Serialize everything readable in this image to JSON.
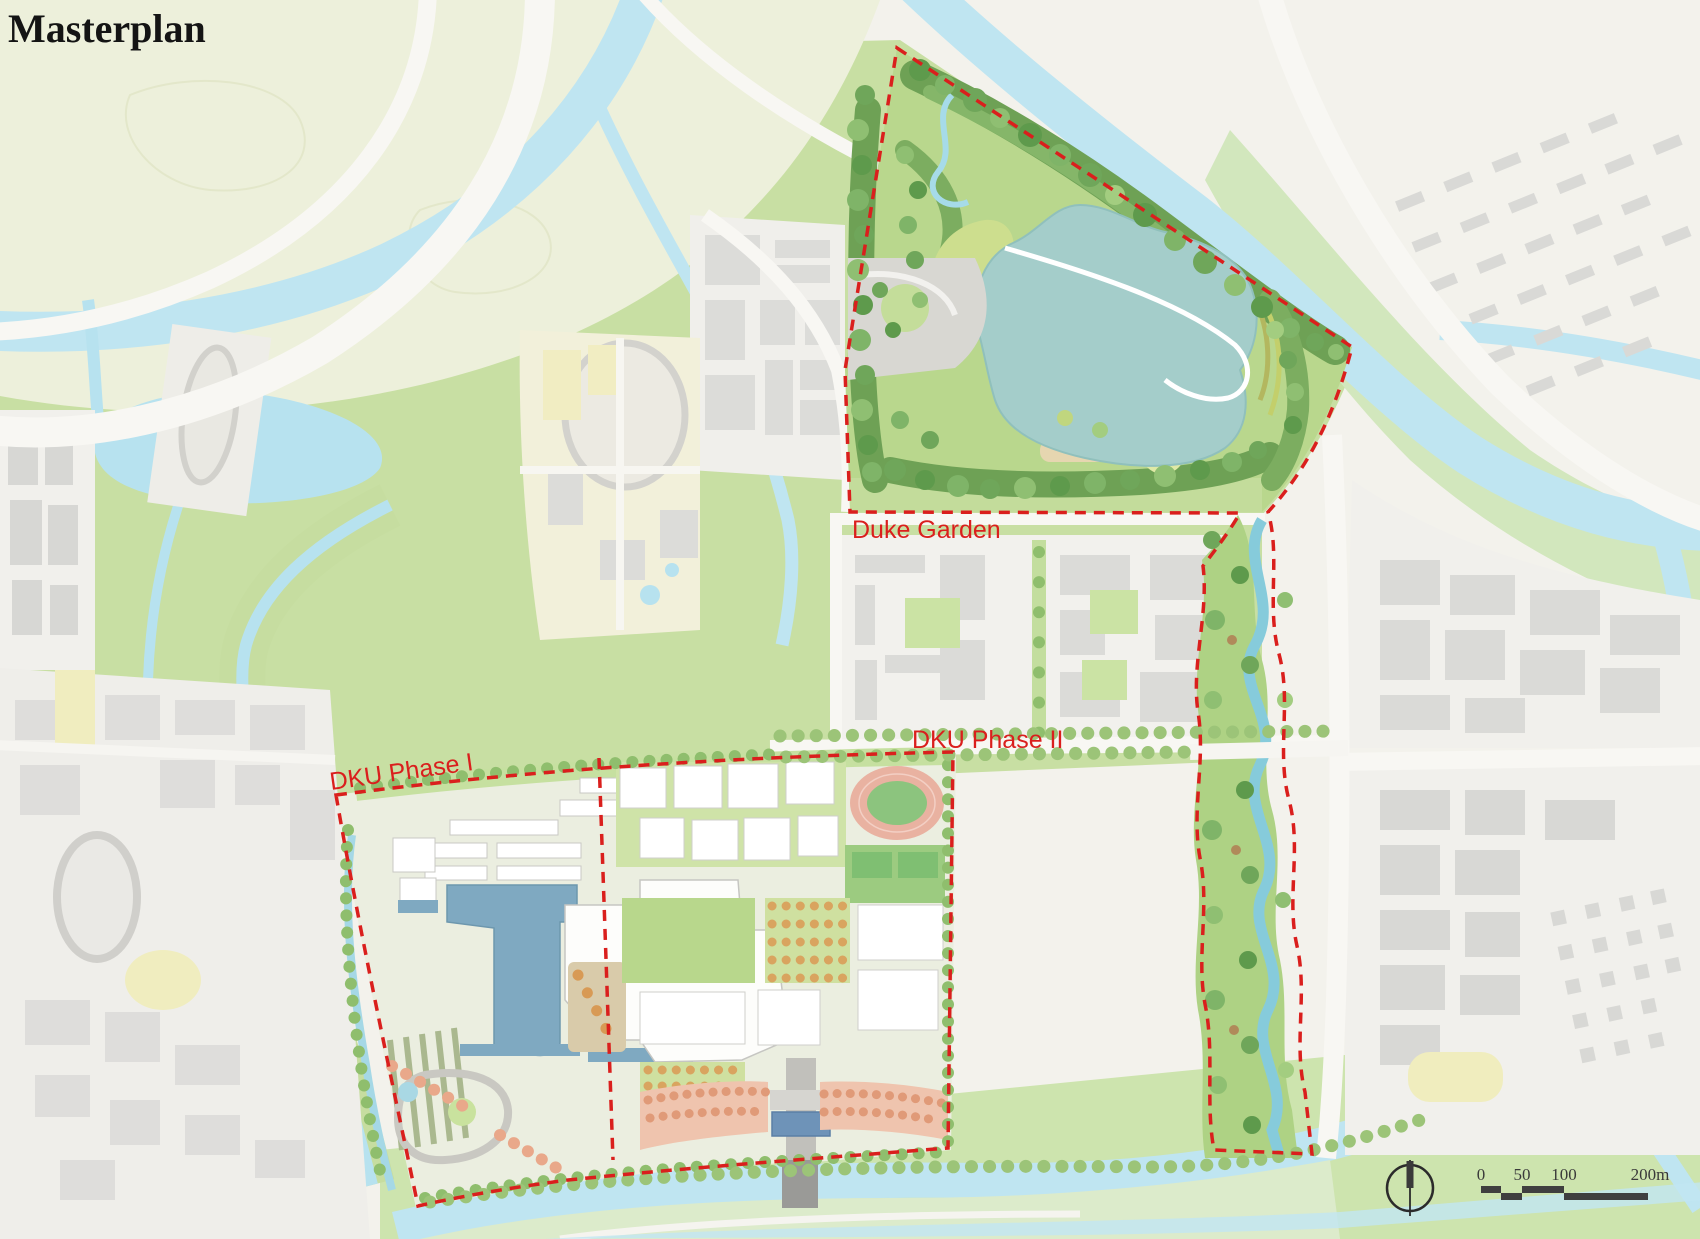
{
  "title": "Masterplan",
  "map": {
    "regions": [
      {
        "id": "duke-garden",
        "label": "Duke Garden"
      },
      {
        "id": "dku-phase-1",
        "label": "DKU Phase I"
      },
      {
        "id": "dku-phase-2",
        "label": "DKU Phase II"
      }
    ]
  },
  "scale_bar": {
    "ticks": [
      "0",
      "50",
      "100",
      "200m"
    ]
  },
  "compass": {
    "name": "north-arrow"
  },
  "colors": {
    "boundary": "#da1f1d",
    "water": "#bfe5f1",
    "lake": "#a4cdca",
    "campus_pond": "#7fa9c1",
    "track_ring": "#e9b2a1",
    "track_field": "#8cc47e",
    "scale_ink": "#3a3a3a"
  }
}
